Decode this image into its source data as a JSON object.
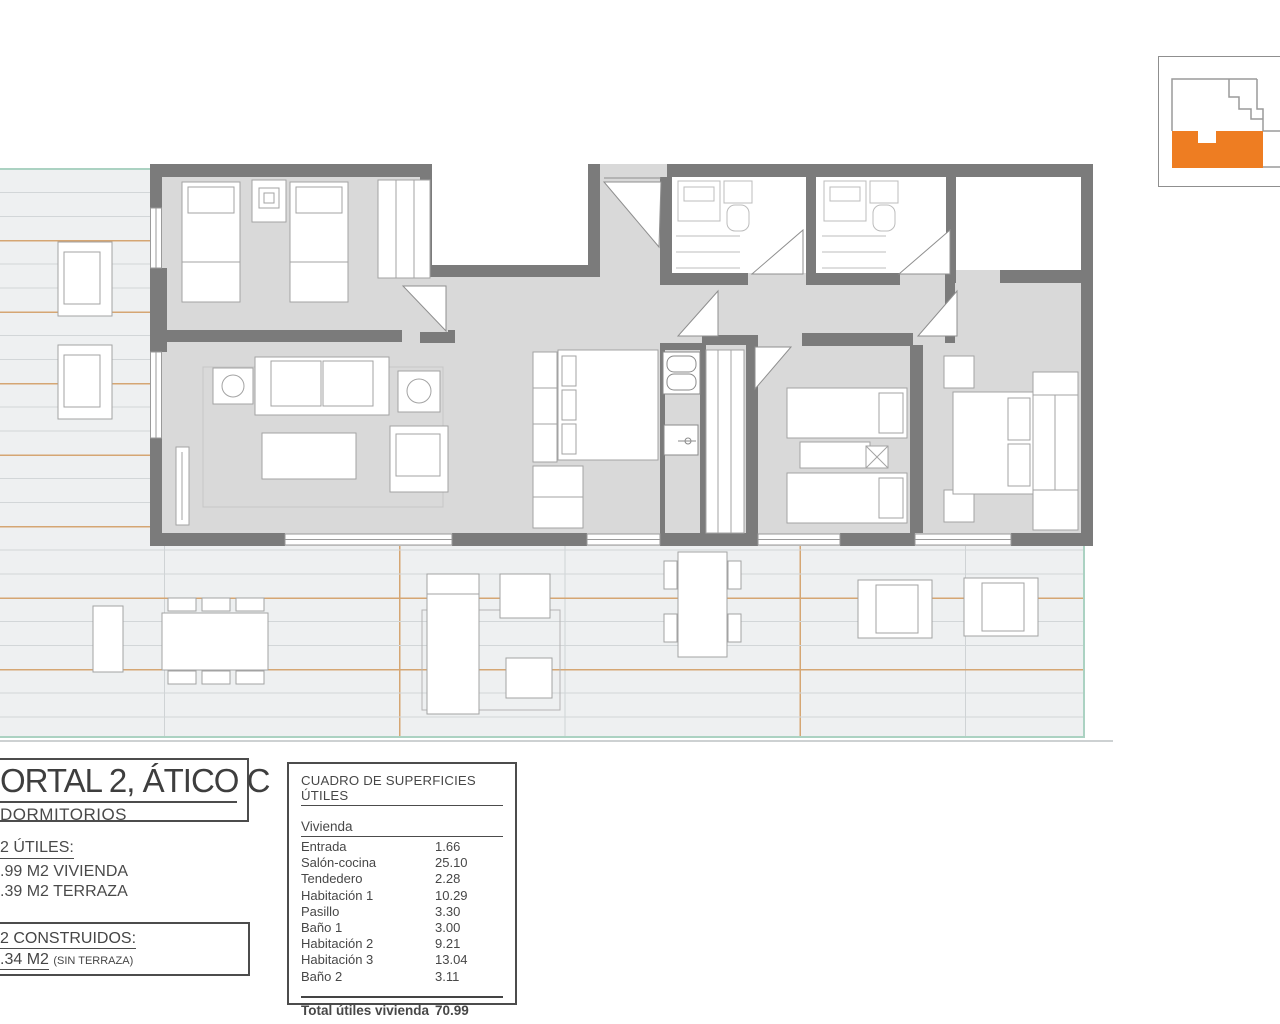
{
  "title_block": {
    "title": "ORTAL 2, ÁTICO C",
    "subtitle": "DORMITORIOS"
  },
  "areas": {
    "utiles_heading": "2 ÚTILES:",
    "utiles_lines": [
      ".99 M2 VIVIENDA",
      ".39 M2 TERRAZA"
    ],
    "construidos_heading": "2 CONSTRUIDOS:",
    "construidos_value": ".34 M2",
    "construidos_note": "(SIN TERRAZA)"
  },
  "surface_table": {
    "title": "CUADRO DE SUPERFICIES ÚTILES",
    "section_header": "Vivienda",
    "rows": [
      {
        "label": "Entrada",
        "value": "1.66"
      },
      {
        "label": "Salón-cocina",
        "value": "25.10"
      },
      {
        "label": "Tendedero",
        "value": "2.28"
      },
      {
        "label": "Habitación 1",
        "value": "10.29"
      },
      {
        "label": "Pasillo",
        "value": "3.30"
      },
      {
        "label": "Baño 1",
        "value": "3.00"
      },
      {
        "label": "Habitación 2",
        "value": "9.21"
      },
      {
        "label": "Habitación 3",
        "value": "13.04"
      },
      {
        "label": "Baño 2",
        "value": "3.11"
      }
    ],
    "total_label": "Total útiles vivienda",
    "total_value": "70.99"
  },
  "keyplan": {
    "highlight_color": "#ee7d22"
  },
  "colors": {
    "wall": "#7b7b7b",
    "apartment_floor": "#d9d9d9",
    "terrace_background": "#eef0f1",
    "terrace_grid_gray": "#cfd3d5",
    "terrace_grid_orange": "#d5a673",
    "terrace_edge_teal": "#abd2c2",
    "text": "#474747",
    "keyplan_highlight": "#ee7d22"
  }
}
